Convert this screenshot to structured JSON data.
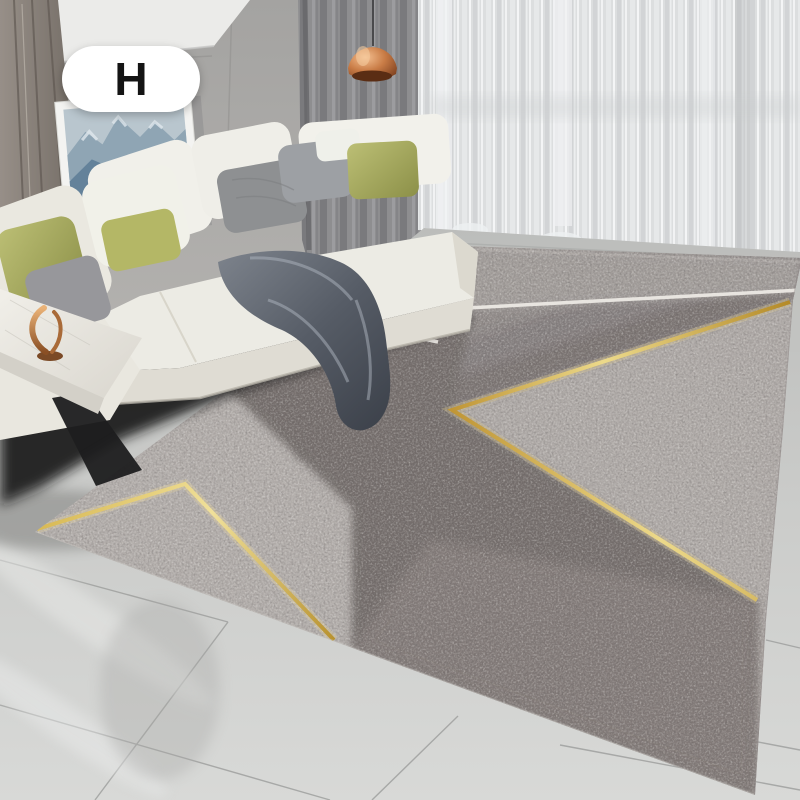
{
  "badge": {
    "label": "H",
    "background": "#ffffff",
    "text_color": "#141414"
  },
  "colors": {
    "gold_line": "#c8a33c",
    "gold_line_bright": "#f0e09a",
    "white_line": "#ece9e4",
    "rug_dark": "#746e6c",
    "rug_light": "#b3aeab",
    "rug_band_top": "#a39e9b",
    "rug_bottom_band": "#867e7c",
    "sofa": "#ecebe4",
    "sofa_front": "#dfdcd3",
    "pillow_olive": "#b4b766",
    "pillow_gray": "#8e9092",
    "throw_blanket": "#565c66",
    "curtain_dark": "#8d8d8f",
    "curtain_sheer": "#dcdedf",
    "lamp_copper": "#c67a44",
    "floor": "#cccdcb",
    "table_marble": "#ece9e3",
    "sculpture_copper": "#b9793f",
    "artwork_mountain": "#7e95a8",
    "wall": "#a8a7a5",
    "wood_panel": "#857d76",
    "shadow": "#141416"
  }
}
